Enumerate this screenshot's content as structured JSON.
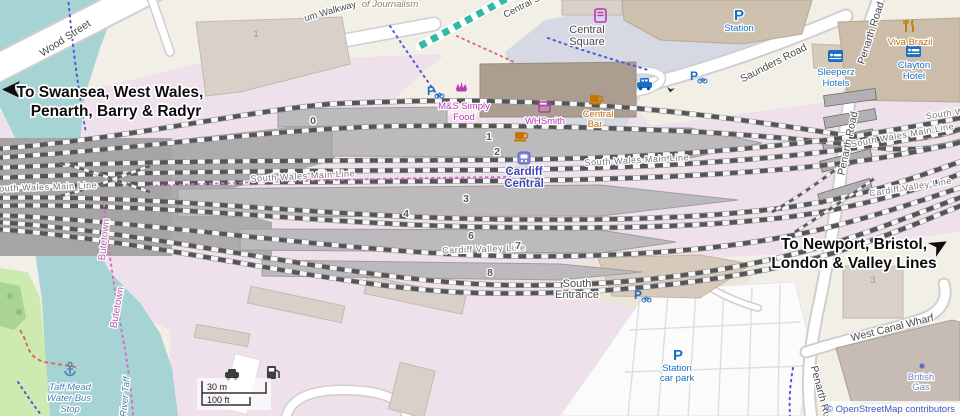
{
  "map": {
    "directions": {
      "west_line1": "To Swansea, West Wales,",
      "west_line2": "Penarth, Barry & Radyr",
      "east_line1": "To Newport, Bristol,",
      "east_line2": "London & Valley Lines"
    },
    "roads": {
      "wood_street": "Wood Street",
      "walkway": "um Walkway",
      "central_s": "Central S",
      "saunders_road": "Saunders Road",
      "penarth_road": "Penarth Road",
      "west_canal_wharf": "West Canal Wharf"
    },
    "railways": {
      "south_wales_main_line": "South Wales Main Line",
      "cardiff_valley_line": "Cardiff Valley Line"
    },
    "station": {
      "name_line1": "Cardiff",
      "name_line2": "Central",
      "platforms": [
        "0",
        "1",
        "2",
        "3",
        "4",
        "6",
        "7",
        "8"
      ],
      "south_entrance_line1": "South",
      "south_entrance_line2": "Entrance"
    },
    "places": {
      "central_square_line1": "Central",
      "central_square_line2": "Square",
      "of_journalism": "of Journalism",
      "butetown": "Butetown",
      "river_taff": "River Taff",
      "house_number_1": "1",
      "house_number_3": "3"
    },
    "pois": {
      "p": "P",
      "station": "Station",
      "ms_line1": "M&S Simply",
      "ms_line2": "Food",
      "whsmith": "WHSmith",
      "bar_line1": "Central",
      "bar_line2": "Bar",
      "sleeperz_line1": "Sleeperz",
      "sleeperz_line2": "Hotels",
      "viva_brazil": "Viva Brazil",
      "clayton_line1": "Clayton",
      "clayton_line2": "Hotel",
      "carpark_line1": "Station",
      "carpark_line2": "car park",
      "taff_line1": "Taff Mead",
      "taff_line2": "Water Bus",
      "taff_line3": "Stop",
      "bg_line1": "British",
      "bg_line2": "Gas"
    },
    "scale": {
      "metric": "30 m",
      "imperial": "100 ft"
    },
    "attribution": "© OpenStreetMap contributors",
    "colors": {
      "water": "#a6d3d3",
      "railway_land": "#eee1ec",
      "plaza": "#d6d9e4",
      "poi_blue": "#1a6fc4",
      "shop_magenta": "#bb37bb",
      "food_orange": "#c06a00",
      "station_blue": "#3c46b4"
    }
  }
}
